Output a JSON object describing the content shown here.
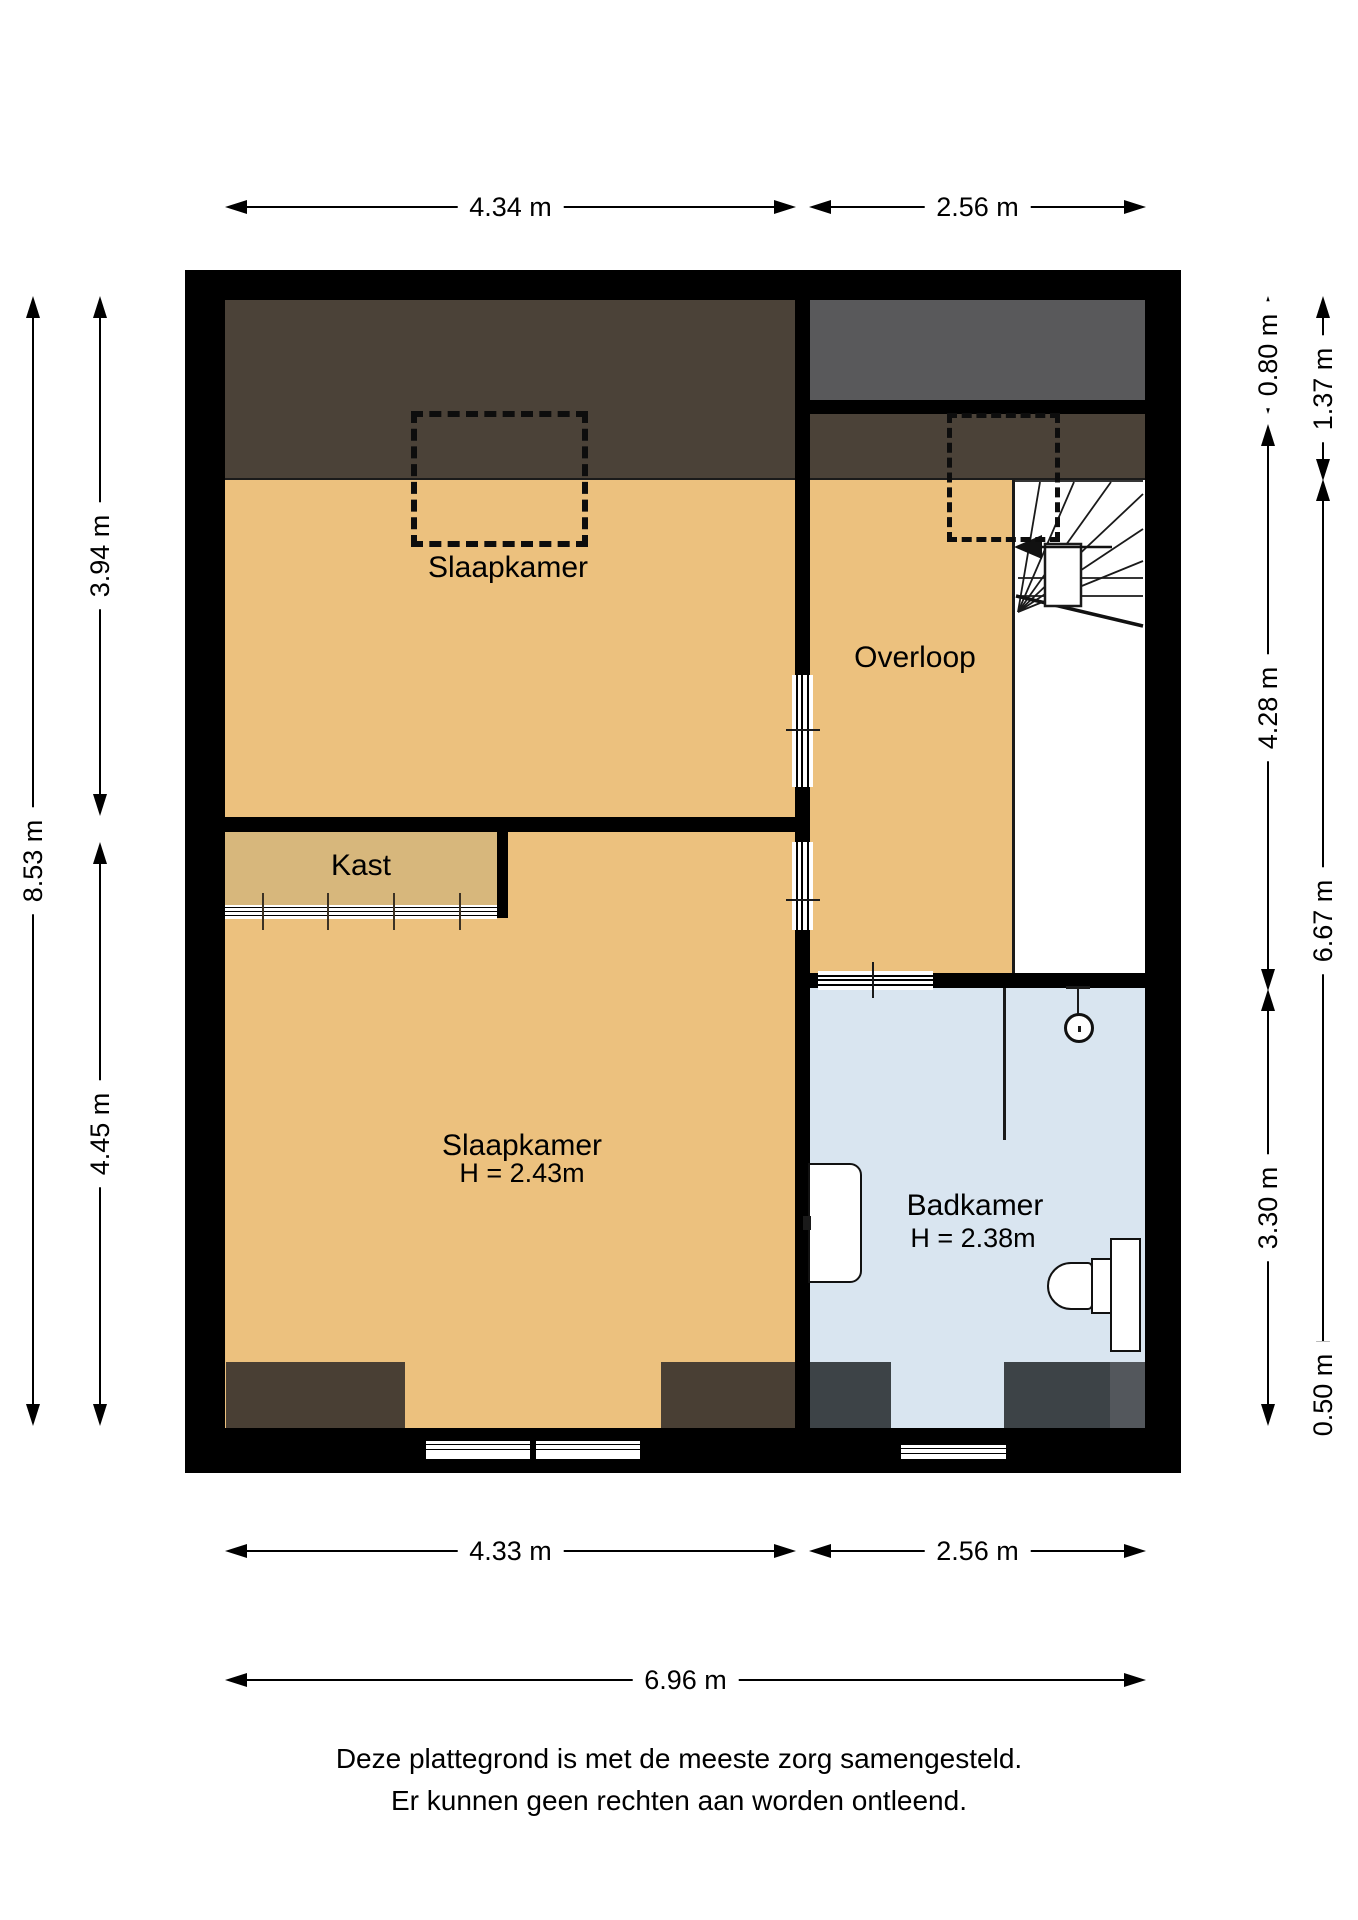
{
  "floorplan": {
    "rooms": {
      "slaapkamer_top": {
        "label": "Slaapkamer"
      },
      "overloop": {
        "label": "Overloop"
      },
      "kast": {
        "label": "Kast"
      },
      "slaapkamer_bottom": {
        "label": "Slaapkamer",
        "height_note": "H = 2.43m"
      },
      "badkamer": {
        "label": "Badkamer",
        "height_note": "H = 2.38m"
      }
    },
    "dimensions": {
      "top": [
        {
          "label": "4.34 m"
        },
        {
          "label": "2.56 m"
        }
      ],
      "bottom": [
        {
          "label": "4.33 m"
        },
        {
          "label": "2.56 m"
        },
        {
          "label": "6.96 m"
        }
      ],
      "left": [
        {
          "label": "8.53 m"
        },
        {
          "label": "3.94 m"
        },
        {
          "label": "4.45 m"
        }
      ],
      "right": [
        {
          "label": "0.80 m"
        },
        {
          "label": "4.28 m"
        },
        {
          "label": "3.30 m"
        },
        {
          "label": "0.50 m"
        },
        {
          "label": "1.37 m"
        },
        {
          "label": "6.67 m"
        }
      ]
    },
    "footer": {
      "line1": "Deze plattegrond is met de meeste zorg samengesteld.",
      "line2": "Er kunnen geen rechten aan worden ontleend."
    },
    "colors": {
      "wall": "#000000",
      "floor_orange": "#ecc17e",
      "kast_tan": "#d7b77c",
      "sloped_ceiling_brown": "#4b4238",
      "roof_gray": "#59595b",
      "bottom_block_brown": "#493f34",
      "bottom_block_slate": "#3d4347",
      "bottom_block_slate_light": "#53575c",
      "badkamer_blue": "#d9e5f0",
      "dimension_line": "#000000"
    }
  }
}
